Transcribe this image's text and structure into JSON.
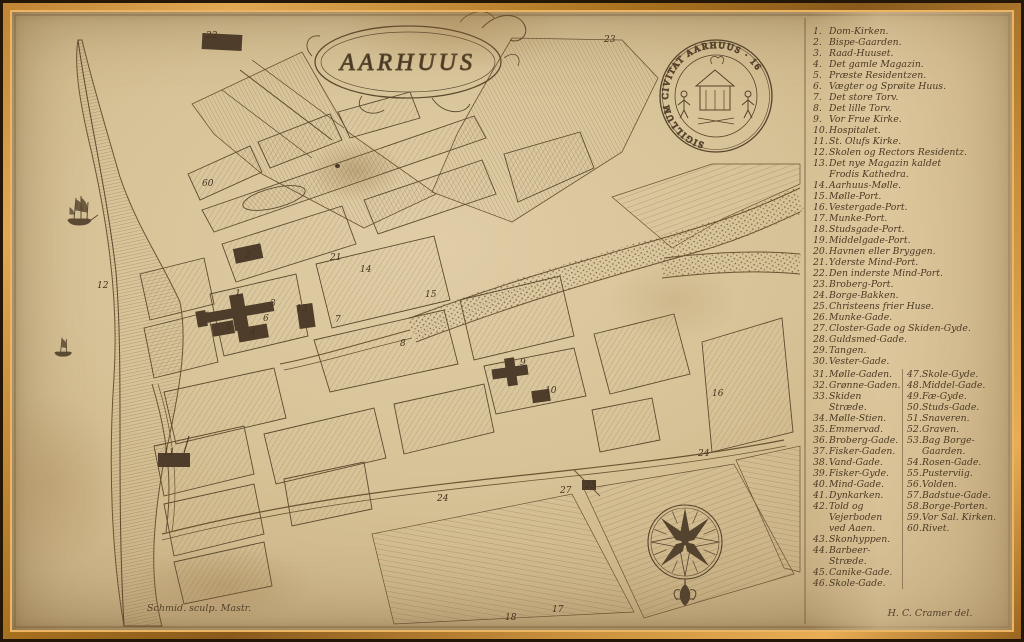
{
  "map": {
    "title": "AARHUUS",
    "seal_inscription": "SIGILLUM CIVITAT AARHUUS · 16",
    "engraver_credit": "Schmid. sculp. Mastr.",
    "author_credit": "H. C. Cramer del.",
    "labels": [
      {
        "n": "22",
        "x": 194,
        "y": 26
      },
      {
        "n": "23",
        "x": 592,
        "y": 30
      },
      {
        "n": "60",
        "x": 190,
        "y": 174
      },
      {
        "n": "12",
        "x": 85,
        "y": 276
      },
      {
        "n": "2",
        "x": 233,
        "y": 246
      },
      {
        "n": "1",
        "x": 223,
        "y": 284
      },
      {
        "n": "3",
        "x": 258,
        "y": 294
      },
      {
        "n": "13",
        "x": 284,
        "y": 299
      },
      {
        "n": "6",
        "x": 251,
        "y": 309
      },
      {
        "n": "5",
        "x": 214,
        "y": 318
      },
      {
        "n": "4",
        "x": 238,
        "y": 323
      },
      {
        "n": "7",
        "x": 323,
        "y": 310
      },
      {
        "n": "21",
        "x": 318,
        "y": 248
      },
      {
        "n": "15",
        "x": 413,
        "y": 285
      },
      {
        "n": "8",
        "x": 388,
        "y": 334
      },
      {
        "n": "14",
        "x": 348,
        "y": 260
      },
      {
        "n": "9",
        "x": 508,
        "y": 353
      },
      {
        "n": "10",
        "x": 533,
        "y": 381
      },
      {
        "n": "11",
        "x": 151,
        "y": 443
      },
      {
        "n": "16",
        "x": 700,
        "y": 384
      },
      {
        "n": "24",
        "x": 686,
        "y": 444
      },
      {
        "n": "24",
        "x": 425,
        "y": 489
      },
      {
        "n": "25",
        "x": 573,
        "y": 476
      },
      {
        "n": "27",
        "x": 548,
        "y": 481
      },
      {
        "n": "18",
        "x": 493,
        "y": 608
      },
      {
        "n": "17",
        "x": 540,
        "y": 600
      }
    ]
  },
  "legend": {
    "items_col1": [
      {
        "n": "1",
        "text": "Dom-Kirken."
      },
      {
        "n": "2",
        "text": "Bispe-Gaarden."
      },
      {
        "n": "3",
        "text": "Raad-Huuset."
      },
      {
        "n": "4",
        "text": "Det gamle Magazin."
      },
      {
        "n": "5",
        "text": "Præste Residentzen."
      },
      {
        "n": "6",
        "text": "Vægter og Sprøite Huus."
      },
      {
        "n": "7",
        "text": "Det store Torv."
      },
      {
        "n": "8",
        "text": "Det lille Torv."
      },
      {
        "n": "9",
        "text": "Vor Frue Kirke."
      },
      {
        "n": "10",
        "text": "Hospitalet."
      },
      {
        "n": "11",
        "text": "St. Olufs Kirke."
      },
      {
        "n": "12",
        "text": "Skolen og Rectors Residentz."
      },
      {
        "n": "13",
        "text": "Det nye Magazin kaldet\nFrodis Kathedra."
      },
      {
        "n": "14",
        "text": "Aarhuus-Mølle."
      },
      {
        "n": "15",
        "text": "Mølle-Port."
      },
      {
        "n": "16",
        "text": "Vestergade-Port."
      },
      {
        "n": "17",
        "text": "Munke-Port."
      },
      {
        "n": "18",
        "text": "Studsgade-Port."
      },
      {
        "n": "19",
        "text": "Middelgade-Port."
      },
      {
        "n": "20",
        "text": "Havnen eller Bryggen."
      },
      {
        "n": "21",
        "text": "Yderste Mind-Port."
      },
      {
        "n": "22",
        "text": "Den inderste Mind-Port."
      },
      {
        "n": "23",
        "text": "Broberg-Port."
      },
      {
        "n": "24",
        "text": "Borge-Bakken."
      },
      {
        "n": "25",
        "text": "Christeens frier Huse."
      },
      {
        "n": "26",
        "text": "Munke-Gade."
      },
      {
        "n": "27",
        "text": "Closter-Gade og Skiden-Gyde."
      },
      {
        "n": "28",
        "text": "Guldsmed-Gade."
      },
      {
        "n": "29",
        "text": "Tangen."
      },
      {
        "n": "30",
        "text": "Vester-Gade."
      }
    ],
    "items_col2_left": [
      {
        "n": "31",
        "text": "Mølle-Gaden."
      },
      {
        "n": "32",
        "text": "Grønne-Gaden."
      },
      {
        "n": "33",
        "text": "Skiden Stræde."
      },
      {
        "n": "34",
        "text": "Mølle-Stien."
      },
      {
        "n": "35",
        "text": "Emmervad."
      },
      {
        "n": "36",
        "text": "Broberg-Gade."
      },
      {
        "n": "37",
        "text": "Fisker-Gaden."
      },
      {
        "n": "38",
        "text": "Vand-Gade."
      },
      {
        "n": "39",
        "text": "Fisker-Gyde."
      },
      {
        "n": "40",
        "text": "Mind-Gade."
      },
      {
        "n": "41",
        "text": "Dynkarken."
      },
      {
        "n": "42",
        "text": "Told og Vejerboden\nved Aaen."
      },
      {
        "n": "43",
        "text": "Skonhyppen."
      },
      {
        "n": "44",
        "text": "Barbeer-Stræde."
      },
      {
        "n": "45",
        "text": "Canike-Gade."
      },
      {
        "n": "46",
        "text": "Skole-Gade."
      }
    ],
    "items_col2_right": [
      {
        "n": "47",
        "text": "Skole-Gyde."
      },
      {
        "n": "48",
        "text": "Middel-Gade."
      },
      {
        "n": "49",
        "text": "Fæ-Gyde."
      },
      {
        "n": "50",
        "text": "Studs-Gade."
      },
      {
        "n": "51",
        "text": "Snaveren."
      },
      {
        "n": "52",
        "text": "Graven."
      },
      {
        "n": "53",
        "text": "Bag Borge-\nGaarden."
      },
      {
        "n": "54",
        "text": "Rosen-Gade."
      },
      {
        "n": "55",
        "text": "Pusterviig."
      },
      {
        "n": "56",
        "text": "Volden."
      },
      {
        "n": "57",
        "text": "Badstue-Gade."
      },
      {
        "n": "58",
        "text": "Borge-Porten."
      },
      {
        "n": "59",
        "text": "Vor Sal. Kirken."
      },
      {
        "n": "60",
        "text": "Rivet."
      }
    ]
  }
}
